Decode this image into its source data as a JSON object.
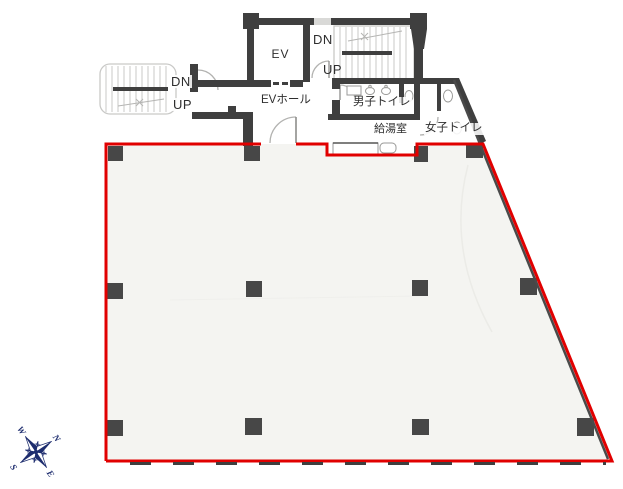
{
  "floorplan": {
    "elevator_label": "EV",
    "ev_hall_label": "EVホール",
    "stairs_right": {
      "down_label": "DN",
      "up_label": "UP"
    },
    "stairs_left": {
      "down_label": "DN",
      "up_label": "UP"
    },
    "mens_toilet_label": "男子トイレ",
    "womens_toilet_label": "女子トイレ",
    "kitchenette_label": "給湯室",
    "compass": {
      "north": "N",
      "east": "E",
      "south": "S",
      "west": "W"
    },
    "colors": {
      "lease_boundary": "#e10000",
      "walls": "#3f3f3f",
      "stair_lines": "#c9c9c7",
      "compass": "#1d2c6e"
    }
  }
}
